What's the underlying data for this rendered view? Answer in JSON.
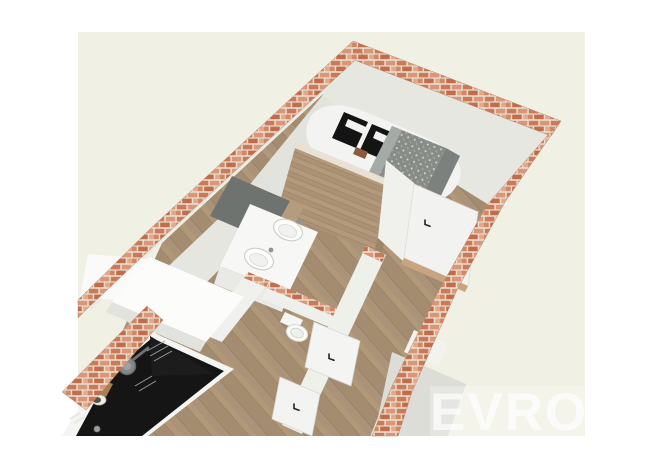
{
  "scene": {
    "description": "3D isometric rendering of a narrow apartment floor plan with brick exterior walls",
    "watermark_text": "EVROD",
    "objects": [
      "brick exterior walls",
      "hardwood plank floor",
      "bedroom with bed, black-and-white striped pillows and grey patterned throw",
      "wooden plank partition wall",
      "bathroom vanity with two white sinks and dark mirror panel",
      "small wc room with toilet",
      "three white interior doors with dark handles",
      "kitchen with black countertop, pan, hob grates, cutting board, bowl and sink",
      "white kitchen wall cabinet"
    ],
    "colors": {
      "page_bg": "#ffffff",
      "render_bg": "#f1f0e4",
      "brick_base": "#c97b59",
      "brick_mortar": "#ecdccc",
      "wood_floor": "#ab9379",
      "wood_panel": "#b39a7c",
      "wall_top": "#f4f4f1",
      "wall_face": "#e6e7e1",
      "mirror_gray": "#6e7370",
      "counter_black": "#151515",
      "blanket_gray": "#878c87",
      "watermark": "#ffffff"
    }
  }
}
